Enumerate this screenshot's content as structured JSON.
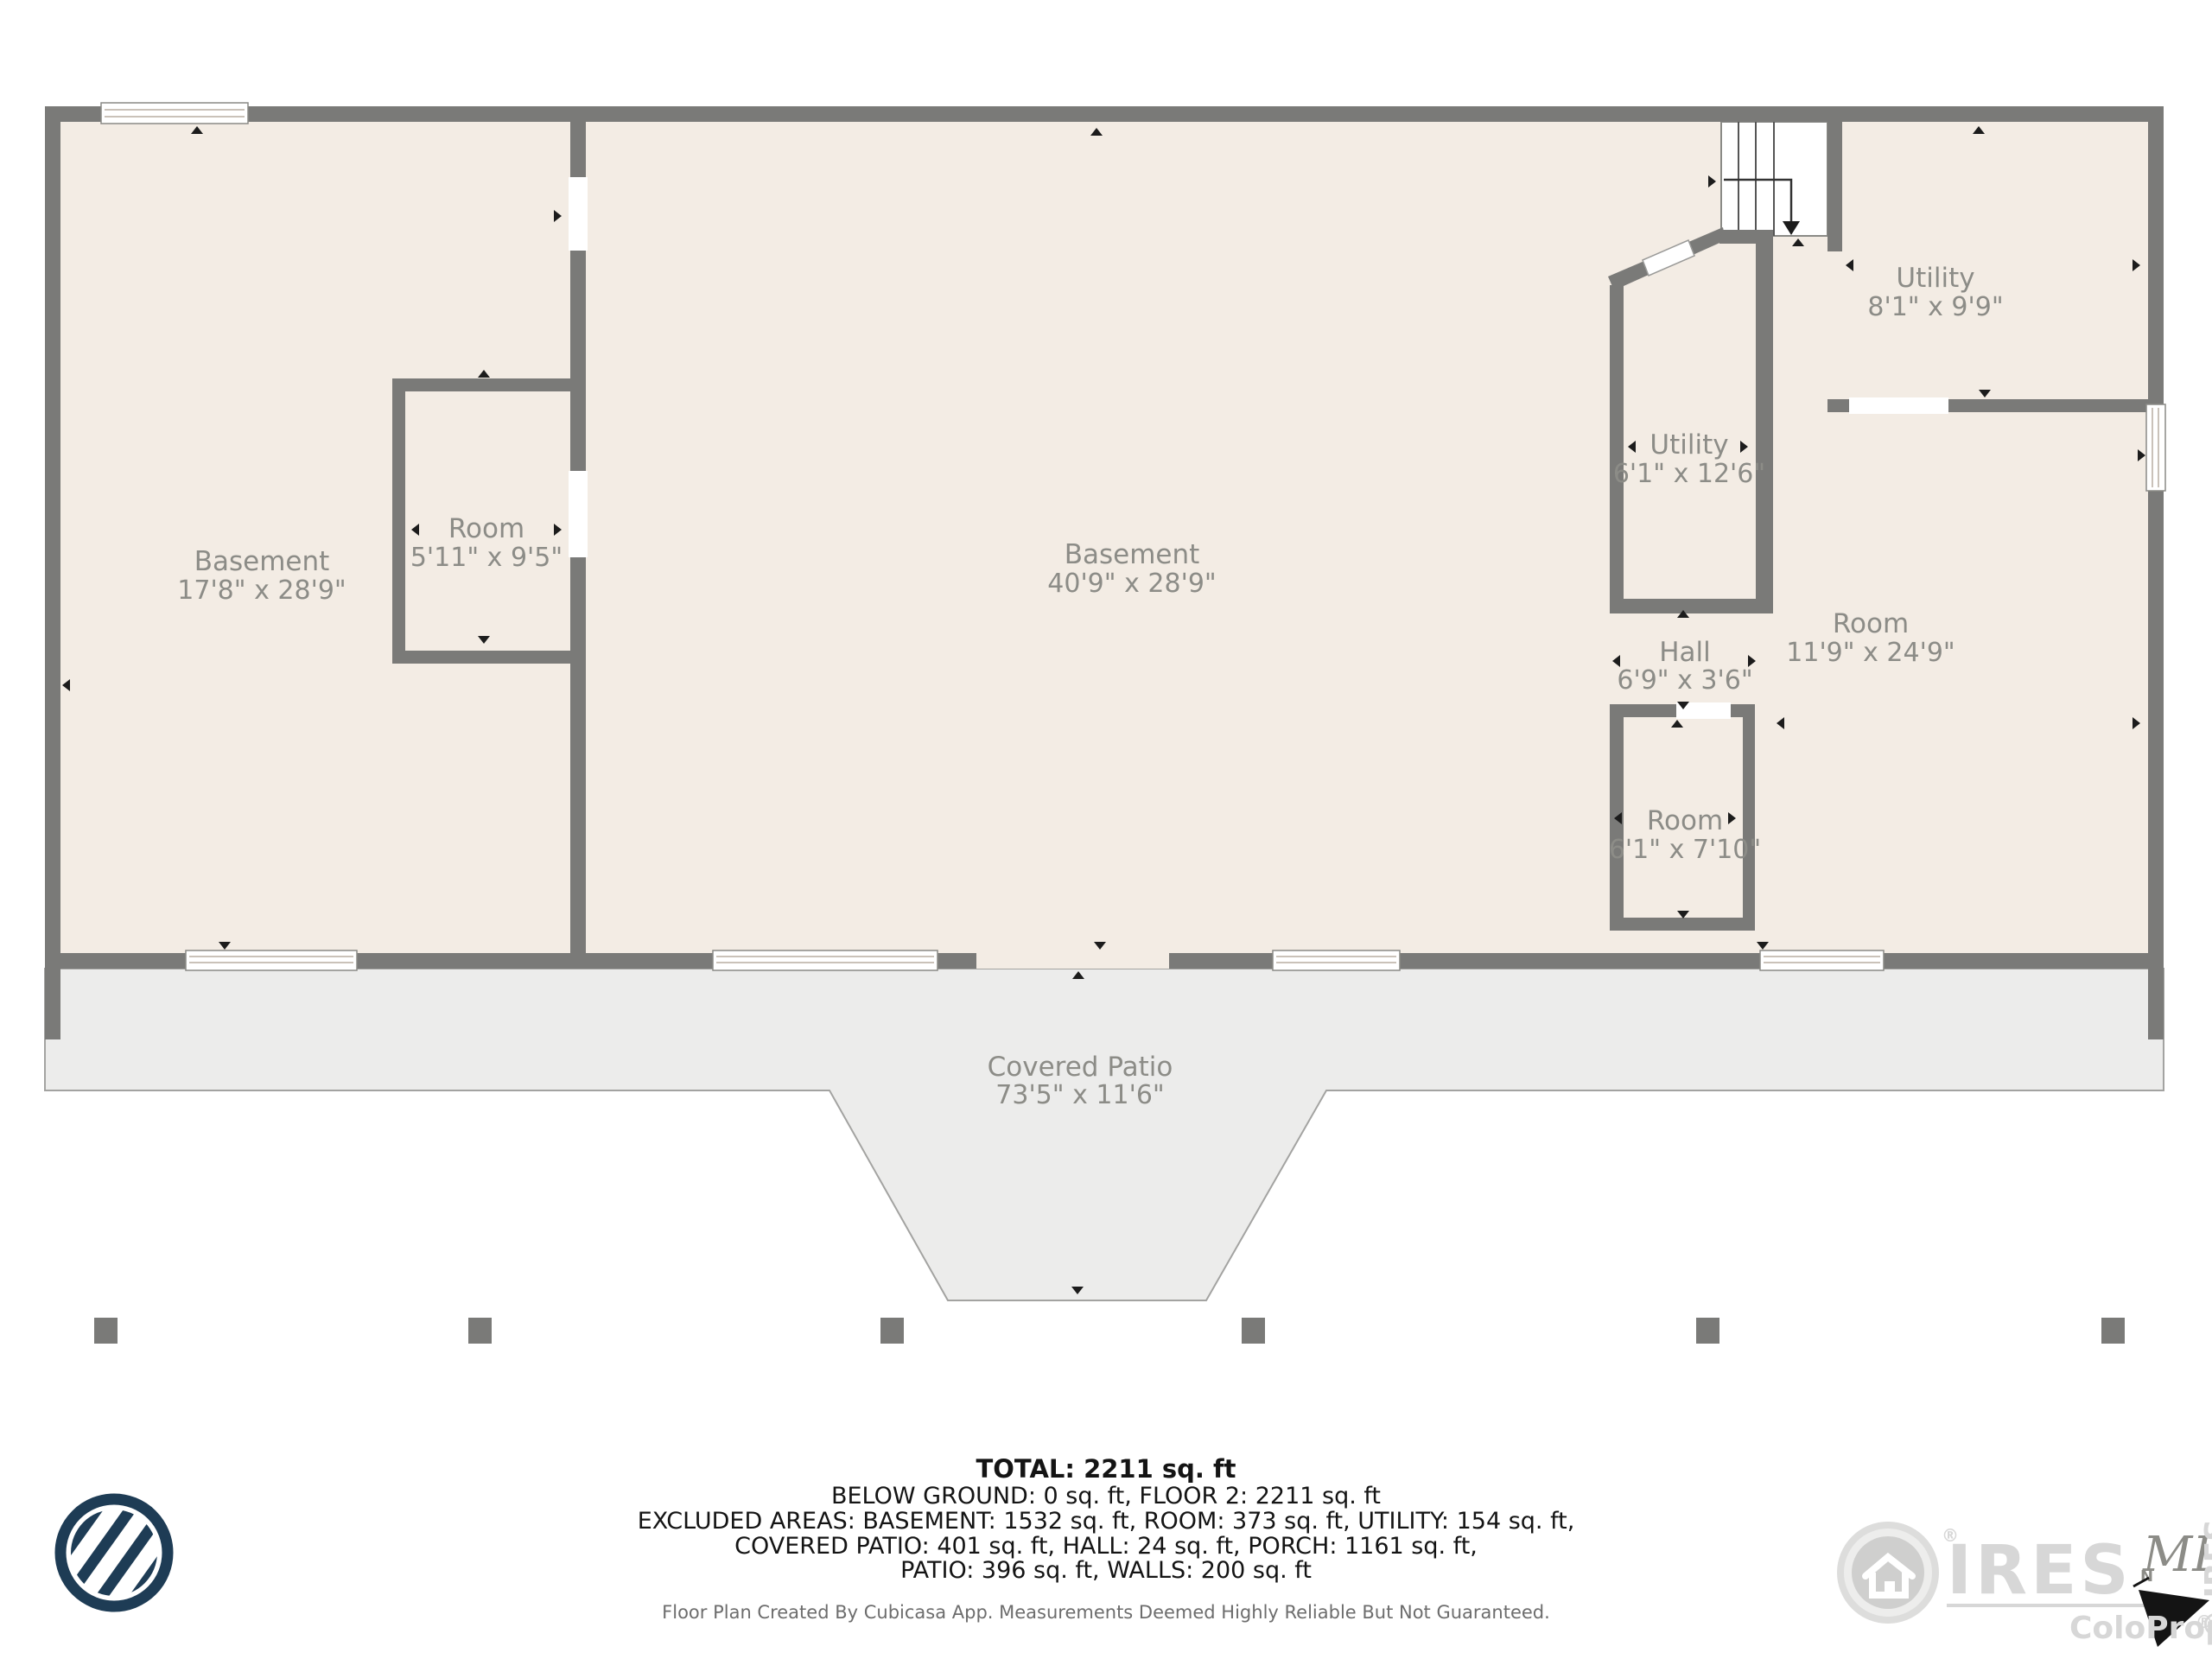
{
  "plan": {
    "rooms": [
      {
        "id": "basement-left",
        "name": "Basement",
        "dims": "17'8\" x 28'9\""
      },
      {
        "id": "room-small",
        "name": "Room",
        "dims": "5'11\" x 9'5\""
      },
      {
        "id": "basement-main",
        "name": "Basement",
        "dims": "40'9\" x 28'9\""
      },
      {
        "id": "utility-tall",
        "name": "Utility",
        "dims": "6'1\" x 12'6\""
      },
      {
        "id": "utility-top",
        "name": "Utility",
        "dims": "8'1\" x 9'9\""
      },
      {
        "id": "hall",
        "name": "Hall",
        "dims": "6'9\" x 3'6\""
      },
      {
        "id": "room-lower",
        "name": "Room",
        "dims": "6'1\" x 7'10\""
      },
      {
        "id": "room-right",
        "name": "Room",
        "dims": "11'9\" x 24'9\""
      },
      {
        "id": "covered-patio",
        "name": "Covered Patio",
        "dims": "73'5\" x 11'6\""
      }
    ],
    "colors": {
      "wall": "#7a7a78",
      "floor": "#f3ece4",
      "patio": "#ececeb",
      "label": "#8c8c87",
      "cubicasa_navy": "#1e3c55"
    }
  },
  "summary": {
    "total": "TOTAL: 2211 sq. ft",
    "line2": "BELOW GROUND: 0 sq. ft, FLOOR 2: 2211 sq. ft",
    "line3": "EXCLUDED AREAS: BASEMENT: 1532 sq. ft, ROOM: 373 sq. ft, UTILITY: 154 sq. ft,",
    "line4": "COVERED PATIO: 401 sq. ft, HALL: 24 sq. ft, PORCH: 1161 sq. ft,",
    "line5": "PATIO: 396 sq. ft, WALLS: 200 sq. ft",
    "footnote": "Floor Plan Created By Cubicasa App. Measurements Deemed Highly Reliable But Not Guaranteed."
  },
  "branding": {
    "ires": {
      "name": "IRES",
      "mls": "MLS",
      "site": "ColoProperty.com",
      "reg": "®",
      "copyright": "© IRES",
      "compass_n": "N"
    }
  }
}
